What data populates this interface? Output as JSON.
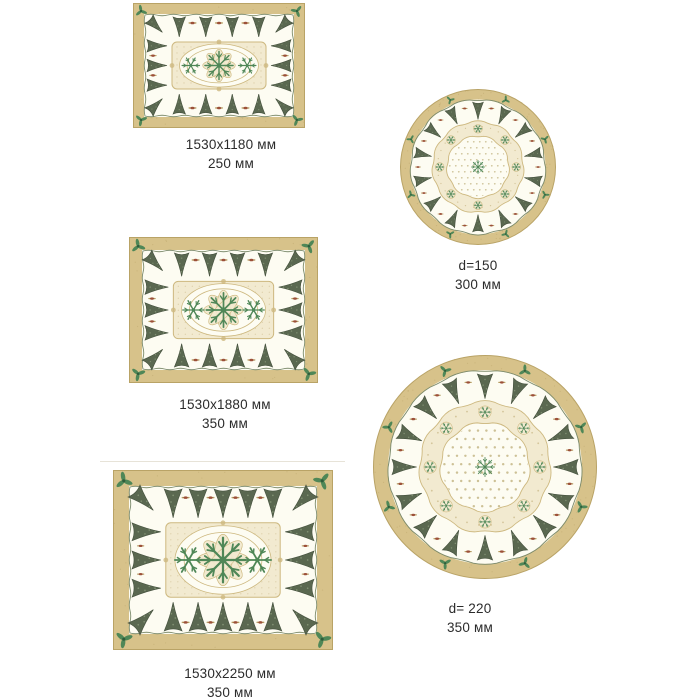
{
  "product_variants": [
    {
      "shape": "rectangle",
      "dimensions": "1530x1180 мм",
      "width": "250 мм"
    },
    {
      "shape": "round",
      "dimensions": "d=150",
      "width": "300 мм"
    },
    {
      "shape": "rectangle",
      "dimensions": "1530x1880 мм",
      "width": "350 мм"
    },
    {
      "shape": "round",
      "dimensions": "d= 220",
      "width": "350 мм"
    },
    {
      "shape": "rectangle",
      "dimensions": "1530x2250 мм",
      "width": "350 мм"
    }
  ],
  "colors": {
    "page_bg": "#ffffff",
    "border_tan": "#d7c28a",
    "border_dark": "#b9a366",
    "cloth_ivory": "#fdfcf2",
    "wavy_line": "#7b8a6b",
    "tree_green": "#5a6850",
    "tree_dark": "#434f3c",
    "tree_light": "#8a9a7a",
    "gold_light": "#f2ead0",
    "gold_mid": "#cdb87f",
    "gold_deep": "#b59f63",
    "accent_green": "#4f8757",
    "holly_dark": "#2f5c3a",
    "motif_brown": "#9c5038",
    "dot_tan": "#cdc196",
    "label_text": "#2b2b2b"
  }
}
